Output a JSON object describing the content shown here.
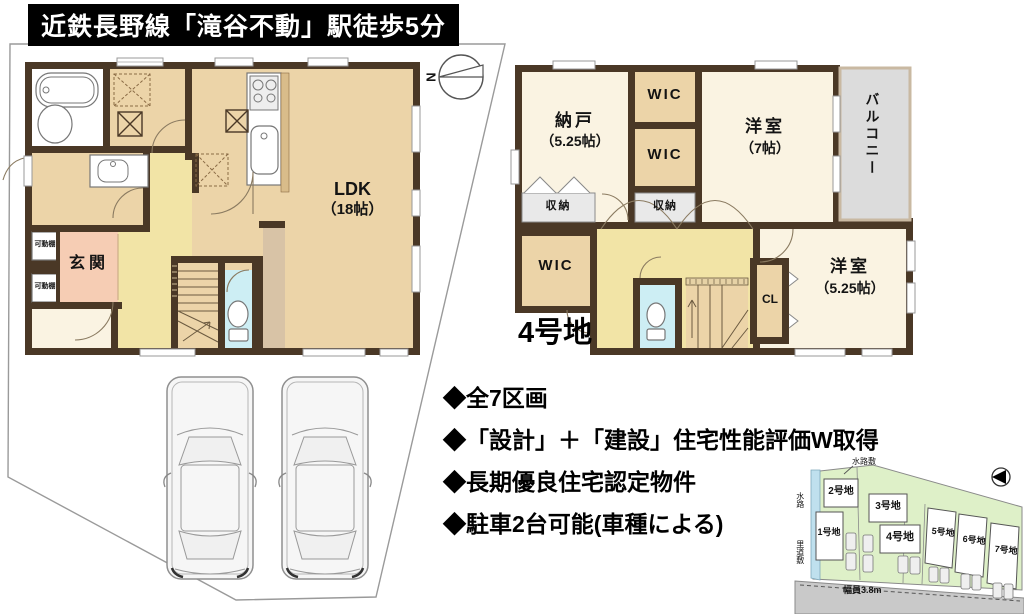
{
  "banner": {
    "text": "近鉄長野線「滝谷不動」駅徒歩5分"
  },
  "floor1": {
    "ldk": "LDK",
    "ldk_size": "（18帖）",
    "genkan": "玄関",
    "shelf_top": "可動棚",
    "shelf_bottom": "可動棚"
  },
  "floor2": {
    "nando": "納戸",
    "nando_size": "（5.25帖）",
    "wic_top": "WIC",
    "wic_mid": "WIC",
    "wic_bottom": "WIC",
    "closet_top": "収納",
    "closet_mid": "収納",
    "yoshitsu7": "洋室",
    "yoshitsu7_size": "（7帖）",
    "balcony": "バルコニー",
    "cl": "CL",
    "yoshitsu5": "洋室",
    "yoshitsu5_size": "（5.25帖）",
    "lot_caption": "4号地"
  },
  "compass": {
    "letter": "N"
  },
  "features": {
    "items": [
      "◆全7区画",
      "◆「設計」＋「建設」住宅性能評価W取得",
      "◆長期優良住宅認定物件",
      "◆駐車2台可能(車種による)"
    ]
  },
  "sitemap": {
    "waterway_area": "水路敷",
    "waterway": "水路",
    "rido": "里道敷",
    "road_width": "幅員3.8m",
    "lots": {
      "lot1": "1号地",
      "lot2": "2号地",
      "lot3": "3号地",
      "lot4": "4号地",
      "lot5": "5号地",
      "lot6": "6号地",
      "lot7": "7号地"
    }
  },
  "colors": {
    "wall": "#4a3826",
    "tan": "#ecd4a8",
    "cream": "#faf3e2",
    "yellow": "#f2e4a6",
    "pink": "#f6cdb4",
    "toilet-blue": "#cdeef4",
    "gray": "#dcdcdc",
    "closet-gray": "#e9e9e9",
    "taupe": "#d8c3a6",
    "hatch": "#d9bc8a",
    "site-green": "#def0c8",
    "road-gray": "#c9c9c9",
    "water-blue": "#bfe0ee"
  }
}
